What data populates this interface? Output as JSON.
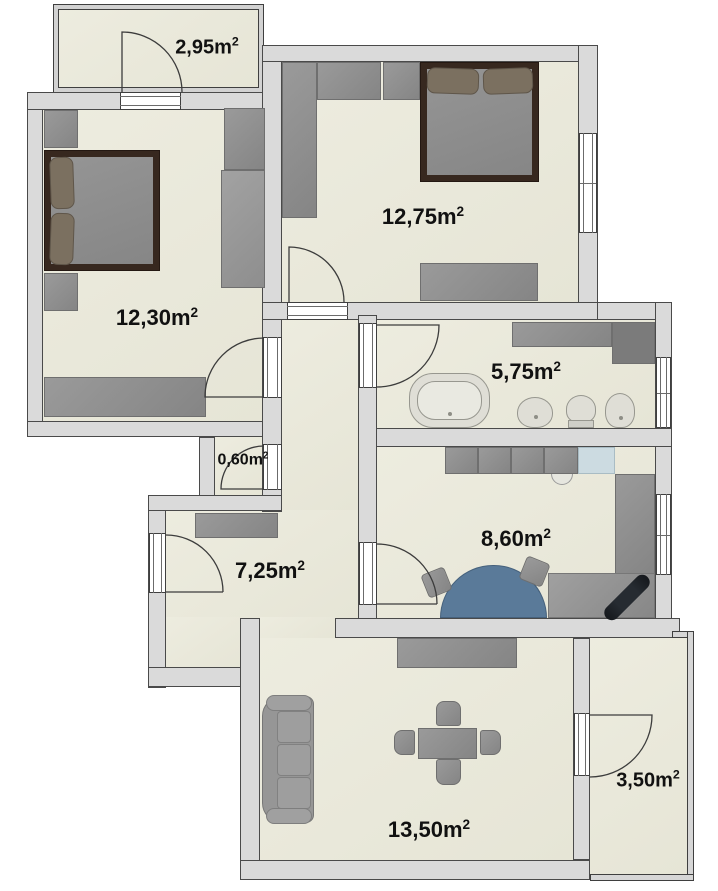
{
  "title": "Apartment floor plan",
  "colors": {
    "background": "#ffffff",
    "wall_fill": "#dadada",
    "wall_outline": "#4a4a4a",
    "floor_beige": "#eae9dc",
    "furniture_gray": "#8f8f8f",
    "bed_frame_brown": "#37281f",
    "pillow_brown": "#7b7060",
    "kitchen_table_blue": "#5a7a99",
    "stove_blue": "#ccdbe1",
    "label_text": "#111111"
  },
  "rooms": [
    {
      "id": "balcony-top",
      "area_label": "2,95m",
      "area_exponent": "2"
    },
    {
      "id": "bedroom-left",
      "area_label": "12,30m",
      "area_exponent": "2"
    },
    {
      "id": "bedroom-right",
      "area_label": "12,75m",
      "area_exponent": "2"
    },
    {
      "id": "bathroom",
      "area_label": "5,75m",
      "area_exponent": "2"
    },
    {
      "id": "closet",
      "area_label": "0,60m",
      "area_exponent": "2"
    },
    {
      "id": "hallway",
      "area_label": "7,25m",
      "area_exponent": "2"
    },
    {
      "id": "kitchen",
      "area_label": "8,60m",
      "area_exponent": "2"
    },
    {
      "id": "living-room",
      "area_label": "13,50m",
      "area_exponent": "2"
    },
    {
      "id": "balcony-bottom",
      "area_label": "3,50m",
      "area_exponent": "2"
    }
  ]
}
